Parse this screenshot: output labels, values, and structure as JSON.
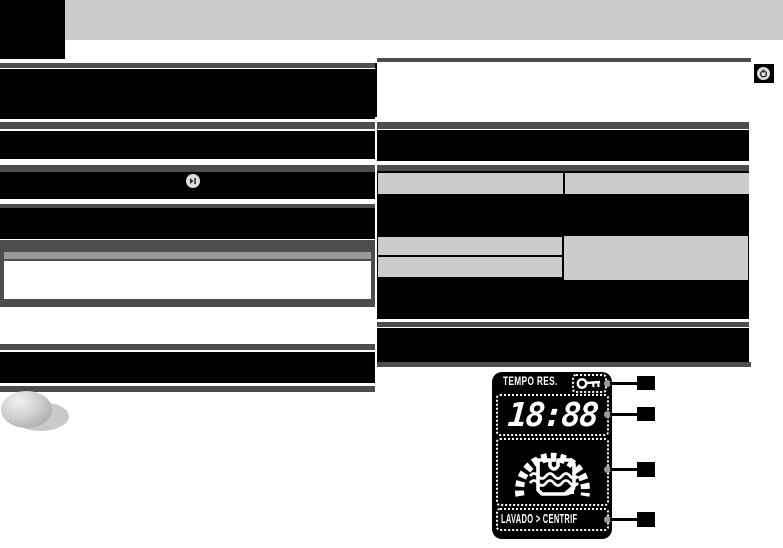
{
  "page": {
    "width": 783,
    "height": 548,
    "type": "scanned-manual-page-with-redacted-text"
  },
  "colors": {
    "background": "#ffffff",
    "banner_gray": "#cbcbcb",
    "divider_gray": "#4d4d4d",
    "redaction_black": "#000000",
    "table_cell_gray": "#cccccc",
    "note_title_gray": "#999999",
    "display_background": "#000000",
    "display_foreground": "#ffffff",
    "connector_dot_gray": "#999999"
  },
  "header": {
    "logo": "black-logo-placeholder"
  },
  "icons": {
    "start_pause": "start-pause-icon",
    "power": "power-icon",
    "key_lock": "key-lock-icon",
    "wash_drum": "wash-drum-progress-icon"
  },
  "display": {
    "timer_label": "TEMPO RES.",
    "time": "18:88",
    "phase": "LAVADO > CENTRIF",
    "progress_segments": 19,
    "callouts": [
      {
        "id": 1,
        "points_to": "key-lock-indicator"
      },
      {
        "id": 2,
        "points_to": "remaining-time-digits"
      },
      {
        "id": 3,
        "points_to": "wash-drum-progress-indicator"
      },
      {
        "id": 4,
        "points_to": "phase-indicator"
      }
    ]
  }
}
